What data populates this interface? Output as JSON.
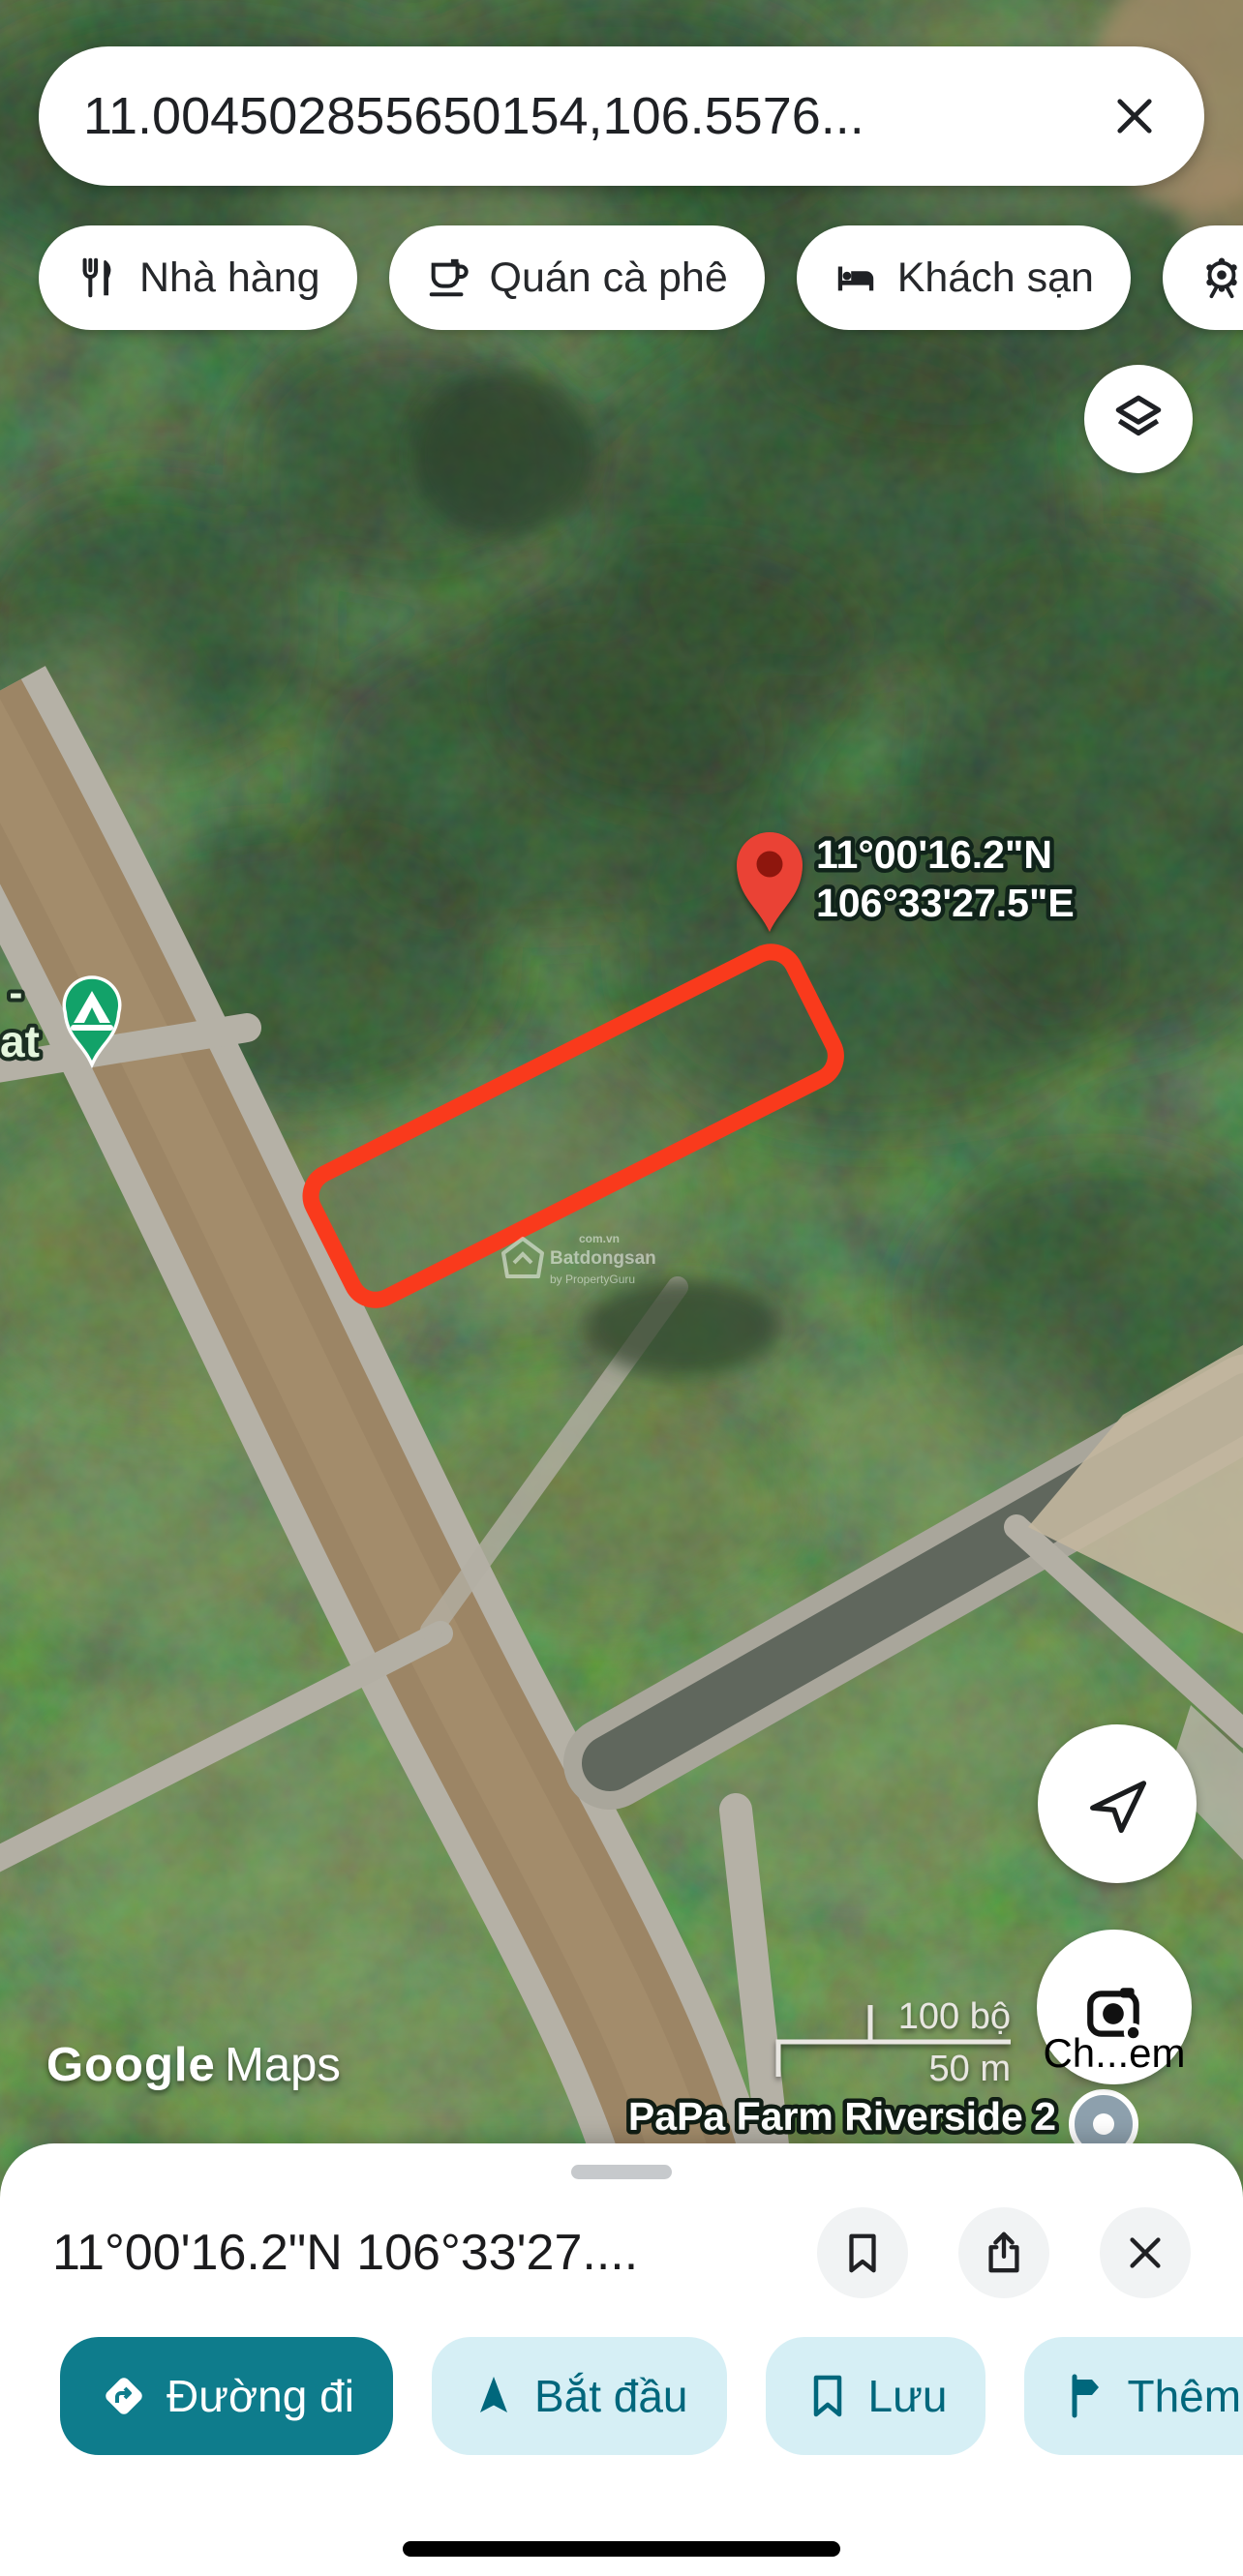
{
  "search": {
    "query": "11.004502855650154,106.5576...",
    "close_icon": "close-x-icon"
  },
  "chips": [
    {
      "icon": "restaurant-icon",
      "label": "Nhà hàng"
    },
    {
      "icon": "cafe-icon",
      "label": "Quán cà phê"
    },
    {
      "icon": "hotel-icon",
      "label": "Khách sạn"
    },
    {
      "icon": "attractions-icon",
      "label": "Địa"
    }
  ],
  "map": {
    "pin": {
      "line1": "11°00'16.2\"N",
      "line2": "106°33'27.5\"E"
    },
    "poi_fragment": {
      "line1": "l -",
      "line2": "at"
    },
    "place_label": "PaPa Farm Riverside 2",
    "scale": {
      "imperial": "100 bộ",
      "metric": "50 m"
    },
    "watermark_google_brand": "Google",
    "watermark_google_word": "Maps",
    "watermark_site": {
      "brand": "Batdongsan",
      "sub": "by PropertyGuru",
      "domain": "com.vn"
    },
    "camera_button_label": "Ch...em"
  },
  "buttons": {
    "layers": "layers-icon",
    "my_location": "navigation-arrow-icon",
    "camera": "camera-lens-icon"
  },
  "sheet": {
    "title": "11°00'16.2\"N 106°33'27....",
    "icon_buttons": [
      "bookmark-icon",
      "share-icon",
      "close-icon"
    ],
    "actions": [
      {
        "icon": "directions-icon",
        "label": "Đường đi",
        "primary": true
      },
      {
        "icon": "navigation-icon",
        "label": "Bắt đầu",
        "primary": false
      },
      {
        "icon": "bookmark-icon",
        "label": "Lưu",
        "primary": false
      },
      {
        "icon": "flag-icon",
        "label": "Thêm",
        "primary": false
      }
    ]
  },
  "colors": {
    "teal": "#0e7c8c",
    "teal_light": "#d6eff5",
    "teal_text": "#00677c",
    "pin_red": "#ea4335",
    "boundary_red": "#f93a1c",
    "marker_green": "#12a269",
    "sheet_bg": "#ffffff"
  }
}
